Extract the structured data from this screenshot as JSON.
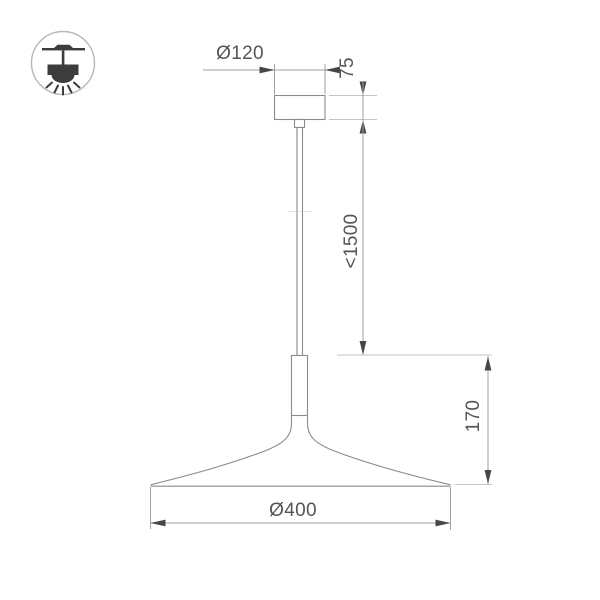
{
  "drawing_title": "pendant-lamp-technical-drawing",
  "icon": {
    "name": "ceiling-pendant-icon"
  },
  "labels": {
    "canopy_diameter": "Ø120",
    "canopy_height": "75",
    "suspension_length": "<1500",
    "fixture_height": "170",
    "shade_diameter": "Ø400"
  },
  "colors": {
    "text": "#555555",
    "arrow": "#464646",
    "outline": "#8a8a8a",
    "dim_line": "#a0a0a0",
    "ext_line": "#c6c6c6",
    "icon_dark": "#3c3c3c",
    "icon_circle": "#b8b8b8",
    "background": "#ffffff"
  }
}
